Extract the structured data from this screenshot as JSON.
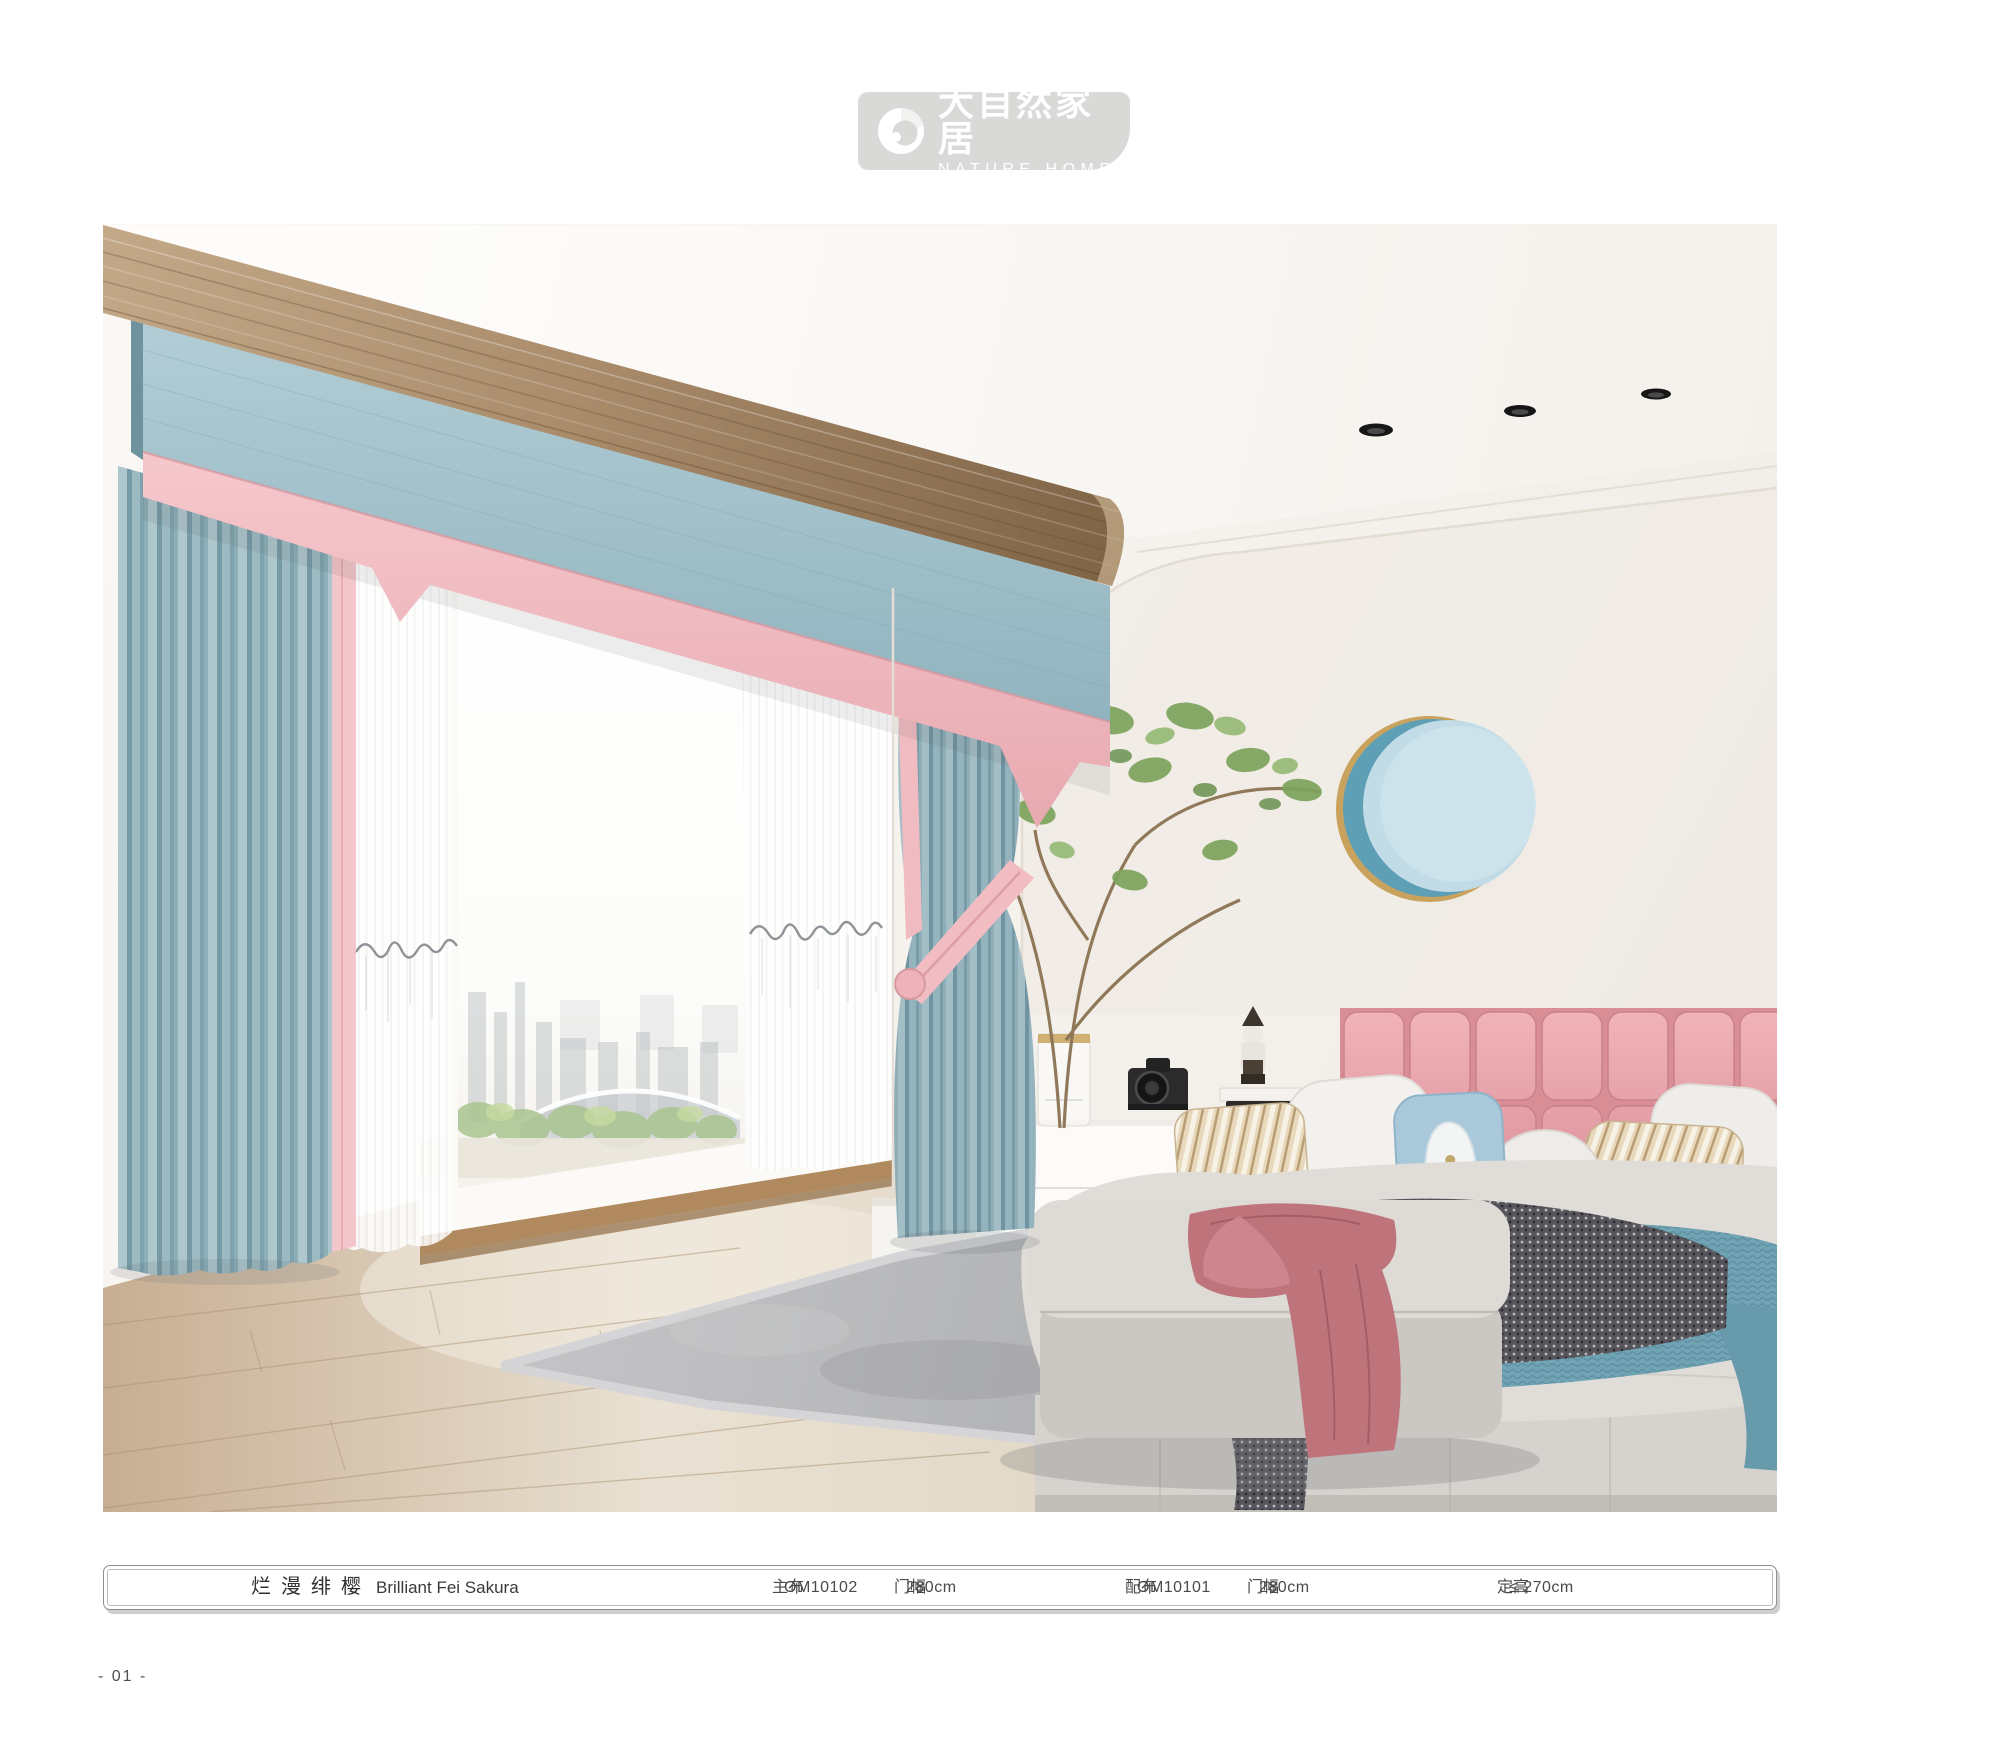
{
  "logo": {
    "name_zh": "大自然家居",
    "name_en": "NATURE HOME"
  },
  "product_bar": {
    "name_zh": "烂漫绯樱",
    "name_en": "Brilliant Fei Sakura",
    "specs": [
      {
        "label": "主布",
        "value": "OM10102"
      },
      {
        "label": "门幅",
        "value": "280cm"
      },
      {
        "label": "配布",
        "value": "OM10101"
      },
      {
        "label": "门幅",
        "value": "280cm"
      },
      {
        "label": "定高",
        "value": "≤ 270cm"
      }
    ]
  },
  "page": {
    "number": "- 01 -"
  },
  "palette": {
    "logo_gray": "#d9d9d7",
    "curtain_blue": "#a4c3cc",
    "curtain_pink": "#f1c1c7",
    "headboard_pink": "#e8a7ad",
    "wood_beam": "#9d8162",
    "wall": "#f6f3ef",
    "carpet_gray": "#b4b5b7",
    "throw_blue": "#70a3b4",
    "throw_mauve": "#bf747b"
  }
}
